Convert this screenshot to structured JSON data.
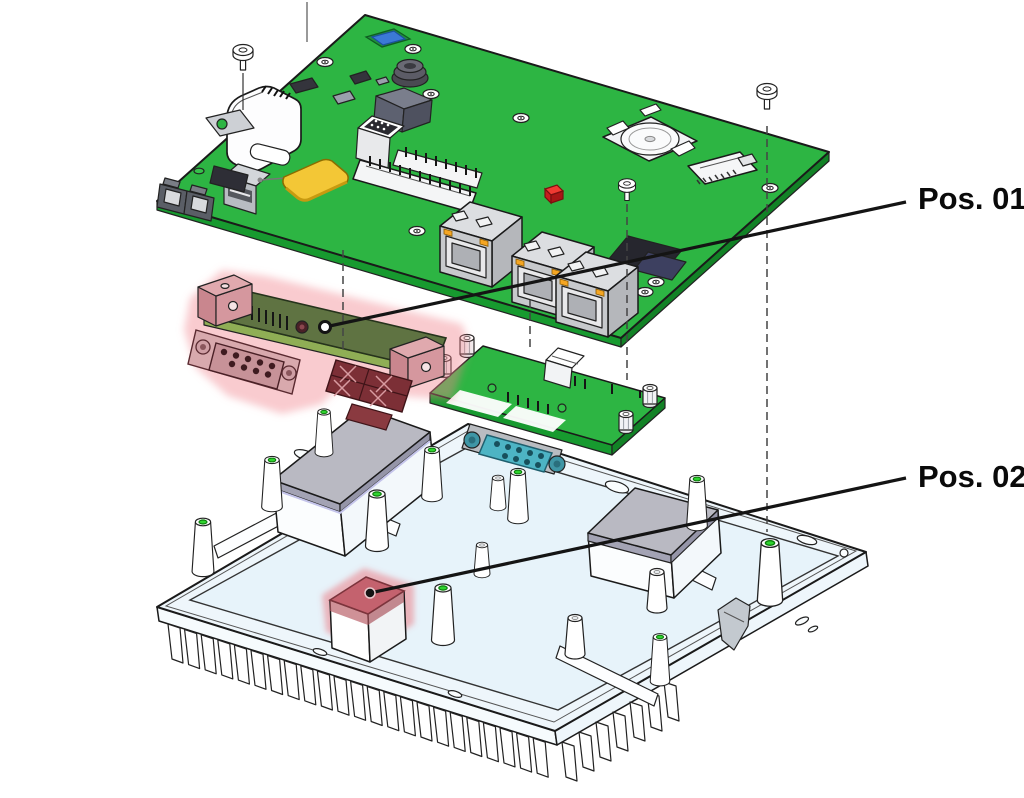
{
  "canvas": {
    "width": 1024,
    "height": 798,
    "background": "#ffffff"
  },
  "callouts": {
    "pos01": {
      "label": "Pos. 01"
    },
    "pos02": {
      "label": "Pos. 02"
    }
  },
  "palette": {
    "pcb_green": "#2db543",
    "pcb_edge_green": "#179a2f",
    "daughter_olive": "#5f7342",
    "highlight_pink": "#ef9aa2",
    "pos02_pad_red": "#c4626e",
    "chassis_blue_white": "#eef6fb",
    "chassis_floor": "#e7f3fa",
    "thermal_pad_gray": "#b9b9c2",
    "teal_connector": "#4db4c4",
    "yellow_pad": "#f3c736",
    "orange_led": "#f5a623",
    "red_led": "#f03a32",
    "screw_hole_green": "#2fd42f",
    "callout_line": "#141414",
    "callout_text": "#0a0a0a"
  }
}
